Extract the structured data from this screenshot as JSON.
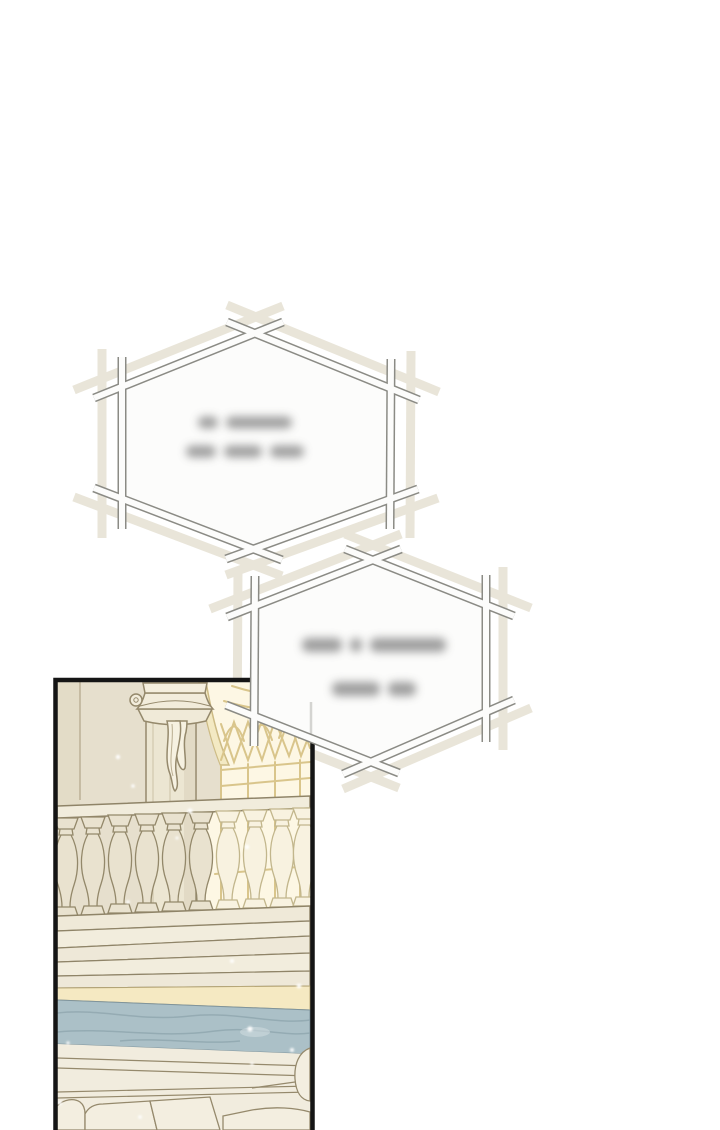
{
  "page": {
    "type": "webtoon-comic-page",
    "background": "#ffffff",
    "width": 720,
    "height": 1130
  },
  "speech_bubbles": [
    {
      "id": "bubble-1",
      "shape": "hexagon-stick-frame",
      "text_state": "blurred-illegible",
      "blur_line_word_widths": [
        [
          20,
          66
        ],
        [
          30,
          38,
          34
        ]
      ],
      "fill": "#fcfcfb",
      "outline_color": "#8b8b85",
      "shadow_color": "#e9e5d9"
    },
    {
      "id": "bubble-2",
      "shape": "hexagon-stick-frame",
      "text_state": "blurred-illegible",
      "blur_line_word_widths": [
        [
          40,
          12,
          76
        ],
        [
          48,
          28
        ]
      ],
      "fill": "#fcfcfb",
      "outline_color": "#8b8b85",
      "shadow_color": "#e9e5d9"
    }
  ],
  "panel": {
    "border_color": "#151515",
    "scene": "palace interior: stone column with carved capital and hanging drapery, pointed-arch window with gold tracery, stone balustrade, stepped ledge with blue-grey marble band, scattered light sparkles",
    "colors": {
      "wall": "#e6dfcd",
      "window_light": "#fdf7e4",
      "tracery_gold": "#d9c58b",
      "column": "#ece6d2",
      "outline_khaki": "#8f8468",
      "balustrade_lit": "#f8f2e0",
      "balustrade_shaded": "#e9e2cf",
      "marble": "#abc0c7",
      "yellow_trim": "#f5e9c2",
      "ledge": "#f1ecdc"
    }
  }
}
